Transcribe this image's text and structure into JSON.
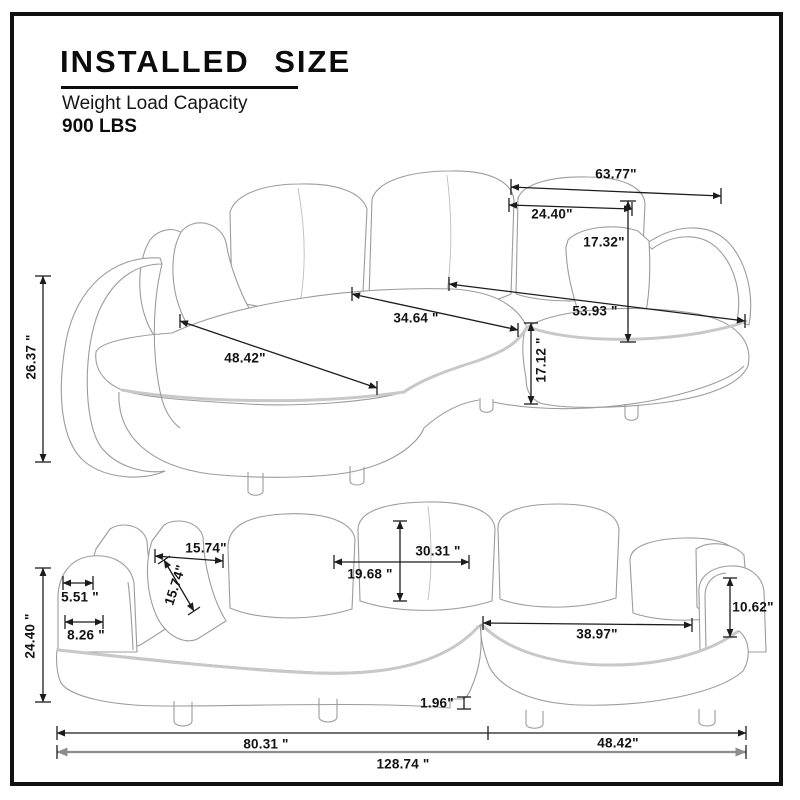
{
  "header": {
    "title": "INSTALLED SIZE",
    "subtitle": "Weight Load Capacity",
    "capacity": "900 LBS"
  },
  "colors": {
    "dimension_line": "#1c1c1c",
    "total_dimension_line": "#8d8d8d",
    "drawing_line": "#9c9c9c",
    "piping_line": "#c8c8c8",
    "frame": "#111111",
    "background": "#ffffff"
  },
  "dims": {
    "top": {
      "back_width": "63.77\"",
      "right_pillow_width": "24.40\"",
      "right_pillow_height": "17.32\"",
      "seat_depth": "34.64 \"",
      "chaise_length": "53.93 \"",
      "left_seat_width": "48.42\"",
      "seat_height": "17.12 \"",
      "arm_height": "26.37 \""
    },
    "front": {
      "pillow_top_width": "15.74\"",
      "pillow_thickness": "15.74\"",
      "back_cushion_width": "30.31 \"",
      "back_cushion_height": "19.68 \"",
      "arm_top_width": "5.51 \"",
      "arm_width": "8.26 \"",
      "overall_height": "24.40 \"",
      "right_arm_height": "10.62\"",
      "right_seat_width": "38.97\"",
      "base_step": "1.96\"",
      "left_section_width": "80.31 \"",
      "right_section_width": "48.42\"",
      "total_width": "128.74 \""
    }
  }
}
